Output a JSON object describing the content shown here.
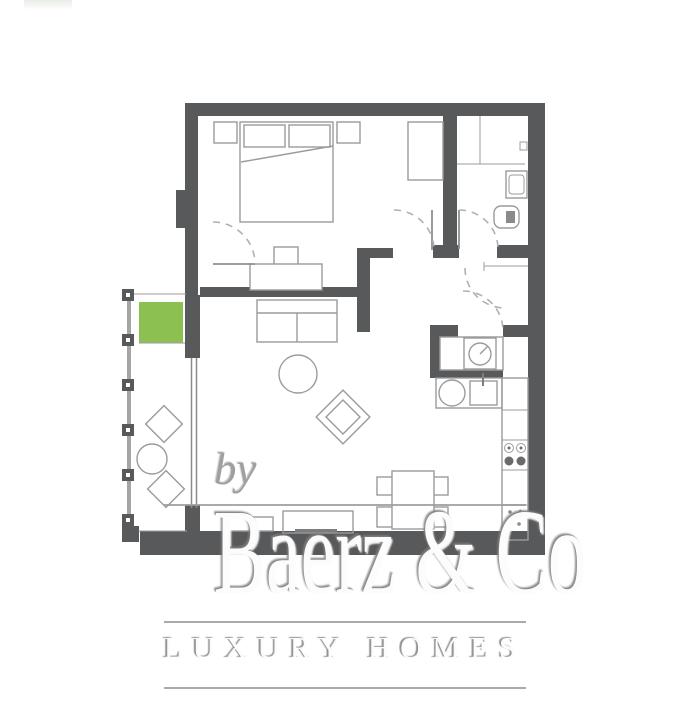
{
  "watermark": {
    "prefix": "by",
    "brand": "Baerz & Co",
    "tagline": "LUXURY HOMES"
  },
  "colors": {
    "page": "#ffffff",
    "wall": "#58595b",
    "line": "#9b9b9b",
    "planter": "#8cc152",
    "watermark_text": "#fcfcfc"
  },
  "floorplan": {
    "type": "apartment-floor-plan",
    "rooms": [
      "bedroom",
      "living-room",
      "kitchen",
      "bathroom",
      "hallway",
      "balcony"
    ],
    "furniture": [
      "double-bed",
      "pillows",
      "nightstand-left",
      "nightstand-right",
      "wardrobe",
      "desk",
      "desk-chair",
      "sofa",
      "round-coffee-table",
      "armchair",
      "sideboard",
      "tv-bench",
      "dining-table",
      "dining-chairs",
      "washing-machine",
      "kitchen-sink",
      "stove-4-burners",
      "kitchen-counter",
      "toilet",
      "washbasin",
      "shower-screen",
      "balcony-planter",
      "balcony-chairs",
      "balcony-table",
      "balcony-railing",
      "sliding-door",
      "door-swings"
    ]
  }
}
